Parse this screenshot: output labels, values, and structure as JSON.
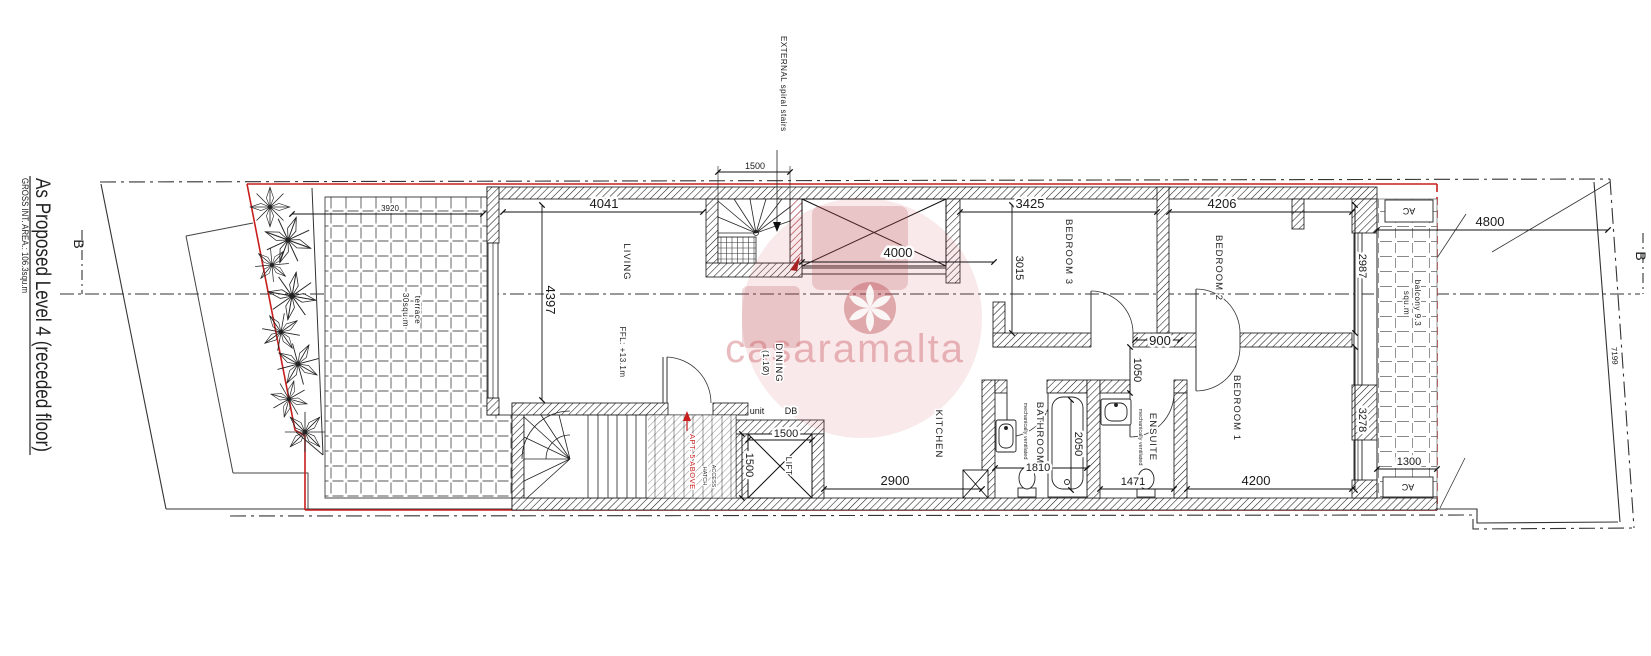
{
  "colors": {
    "property_line": "#c81e1e",
    "drawing": "#1a1a1a",
    "watermark_pink": "#c8545c"
  },
  "title_block": {
    "title": "As Proposed Level 4 (receded floor)",
    "gross_area": "GROSS INT. AREA.: 106.3squ.m"
  },
  "section_markers": {
    "left": "B",
    "right": "B"
  },
  "watermark": {
    "text": "casaramalta"
  },
  "rooms": {
    "living": "LIVING",
    "dining": "DINING",
    "dining_note": "(1.1Ø)",
    "kitchen": "KITCHEN",
    "bathroom": "BATHROOM",
    "vent_note": "mechanically ventilated",
    "ensuite": "ENSUITE",
    "bedroom1": "BEDROOM 1",
    "bedroom2": "BEDROOM 2",
    "bedroom3": "BEDROOM 3",
    "lift": "LIFT",
    "terrace_name": "terrace",
    "terrace_area": "30squ.m",
    "balcony_name": "balcony 9.3",
    "balcony_area": "squ.m"
  },
  "annotations": {
    "external_stairs": "EXTERNAL spiral stairs",
    "ffl": "FFL: +13.1m",
    "apt_above": "APT. 5 ABOVE",
    "access": "ACCESS",
    "hatch": "HATCH",
    "unit": "unit",
    "db": "DB",
    "ac": "AC"
  },
  "dimensions": {
    "d3920": "3920",
    "d4041": "4041",
    "d1500_spiral": "1500",
    "d4000": "4000",
    "d3425": "3425",
    "d4206": "4206",
    "d4800": "4800",
    "d4397": "4397",
    "d3015": "3015",
    "d2987": "2987",
    "d900": "900",
    "d1050": "1050",
    "d2050": "2050",
    "d1810": "1810",
    "d2900": "2900",
    "d1471": "1471",
    "d4200": "4200",
    "d3278": "3278",
    "d1300": "1300",
    "d1500_lift_w": "1500",
    "d1500_lift_h": "1500",
    "d7199": "7199"
  }
}
